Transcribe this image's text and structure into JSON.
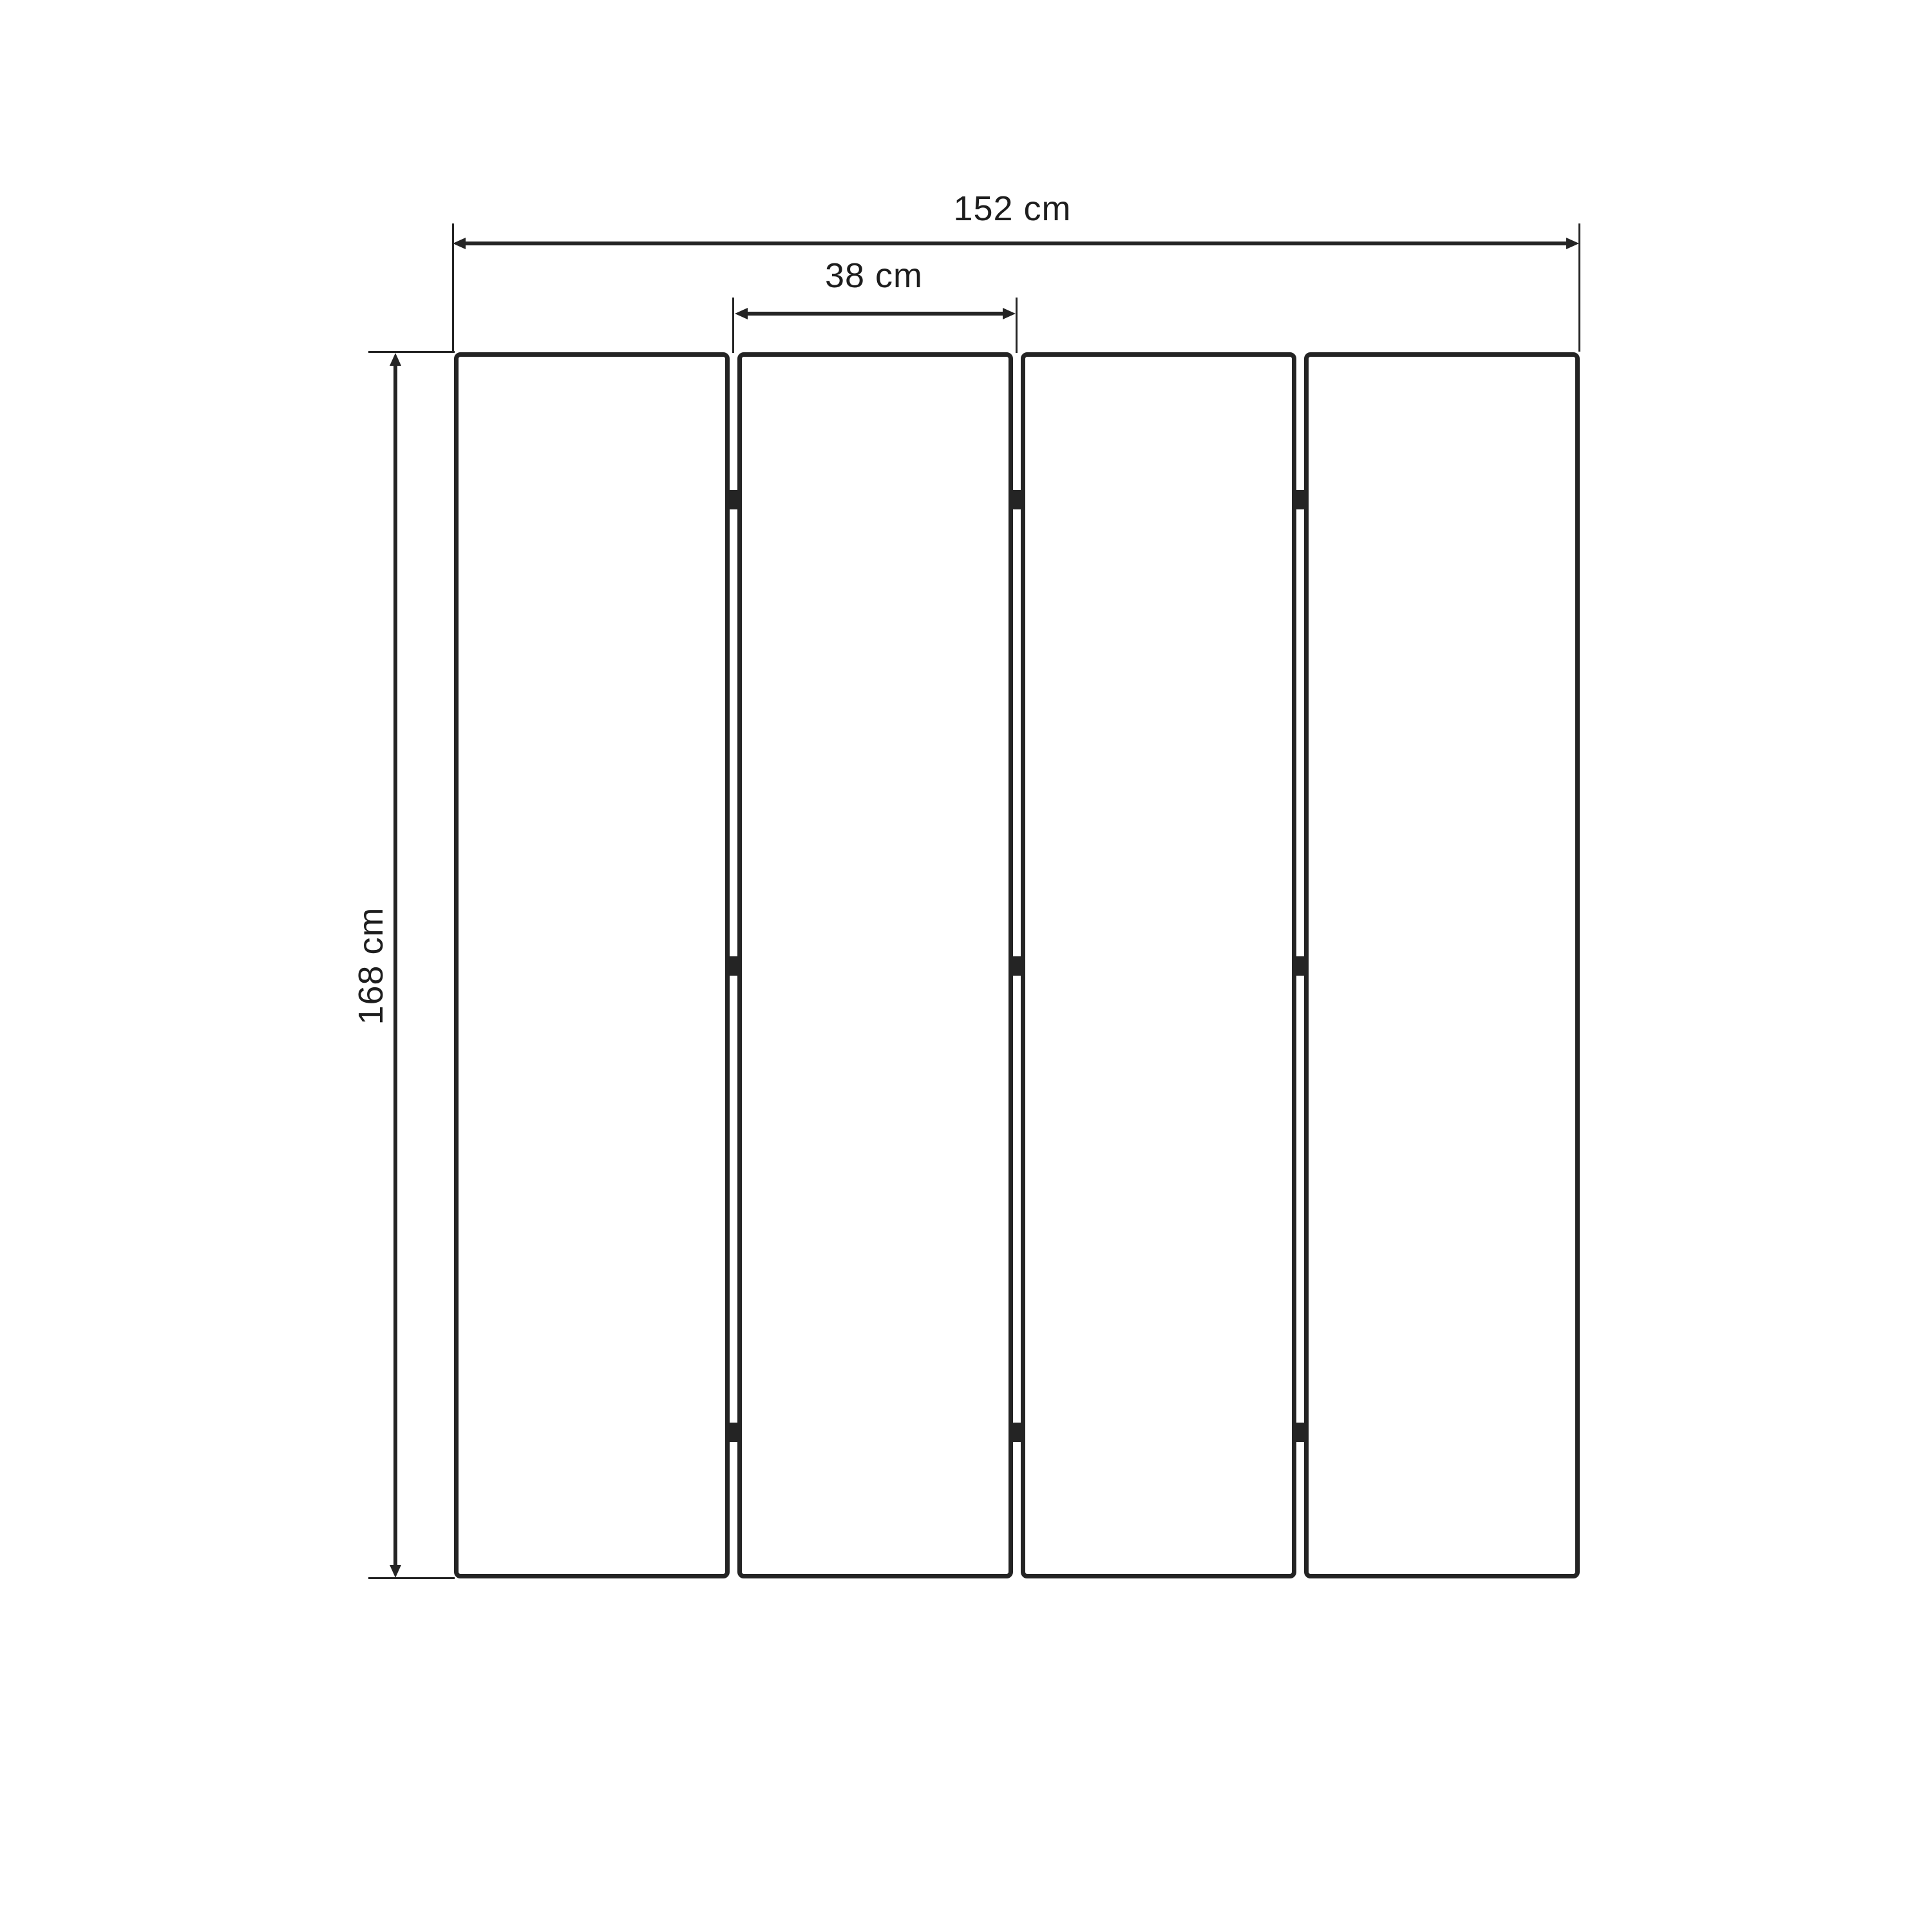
{
  "dimensions": {
    "total_width": "152 cm",
    "panel_width": "38 cm",
    "height": "168 cm"
  },
  "panels": {
    "count": 4,
    "hinge_rows": 3,
    "hinge_count": 9
  },
  "colors": {
    "line": "#242424",
    "text": "#1d1d1d",
    "background": "#ffffff",
    "panel_fill": "#ffffff"
  }
}
